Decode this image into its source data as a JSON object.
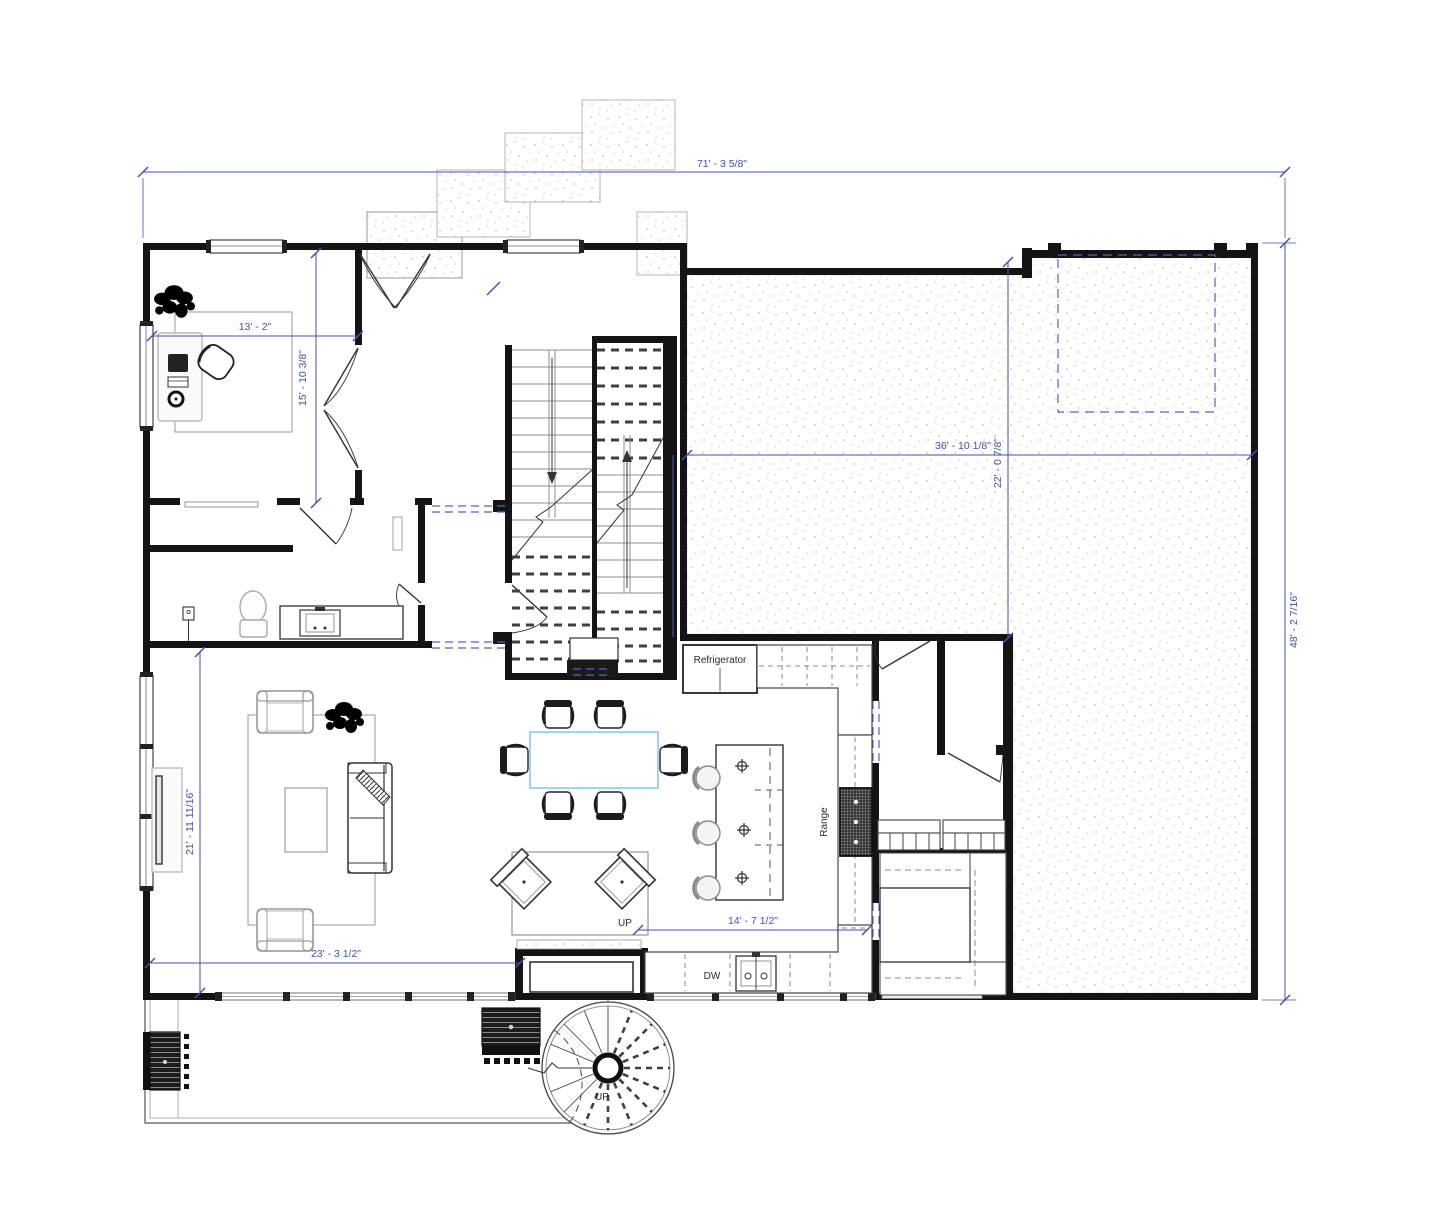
{
  "drawing": {
    "labels": {
      "refrigerator": "Refrigerator",
      "range": "Range",
      "dw": "DW",
      "up_main": "UP",
      "up_spiral": "UP"
    },
    "dims": {
      "overall_width": "71' - 3 5/8\"",
      "overall_height": "48' - 2 7/16\"",
      "office_w": "13' - 2\"",
      "office_h": "15' - 10 3/8\"",
      "garage_w": "36' - 10 1/8\"",
      "garage_h": "22' - 0 7/8\"",
      "living_h": "21' - 11 11/16\"",
      "living_w": "23' - 3 1/2\"",
      "kitchen_w": "14' - 7 1/2\""
    },
    "colors": {
      "dimension_blue": "#4350ae",
      "reference_dash_blue": "#5562c8",
      "wall_black": "#141414",
      "furniture_gray": "#8a8a8a",
      "table_accent_blue": "#a3d3e6",
      "stipple_gray": "#c6c6cb"
    }
  }
}
